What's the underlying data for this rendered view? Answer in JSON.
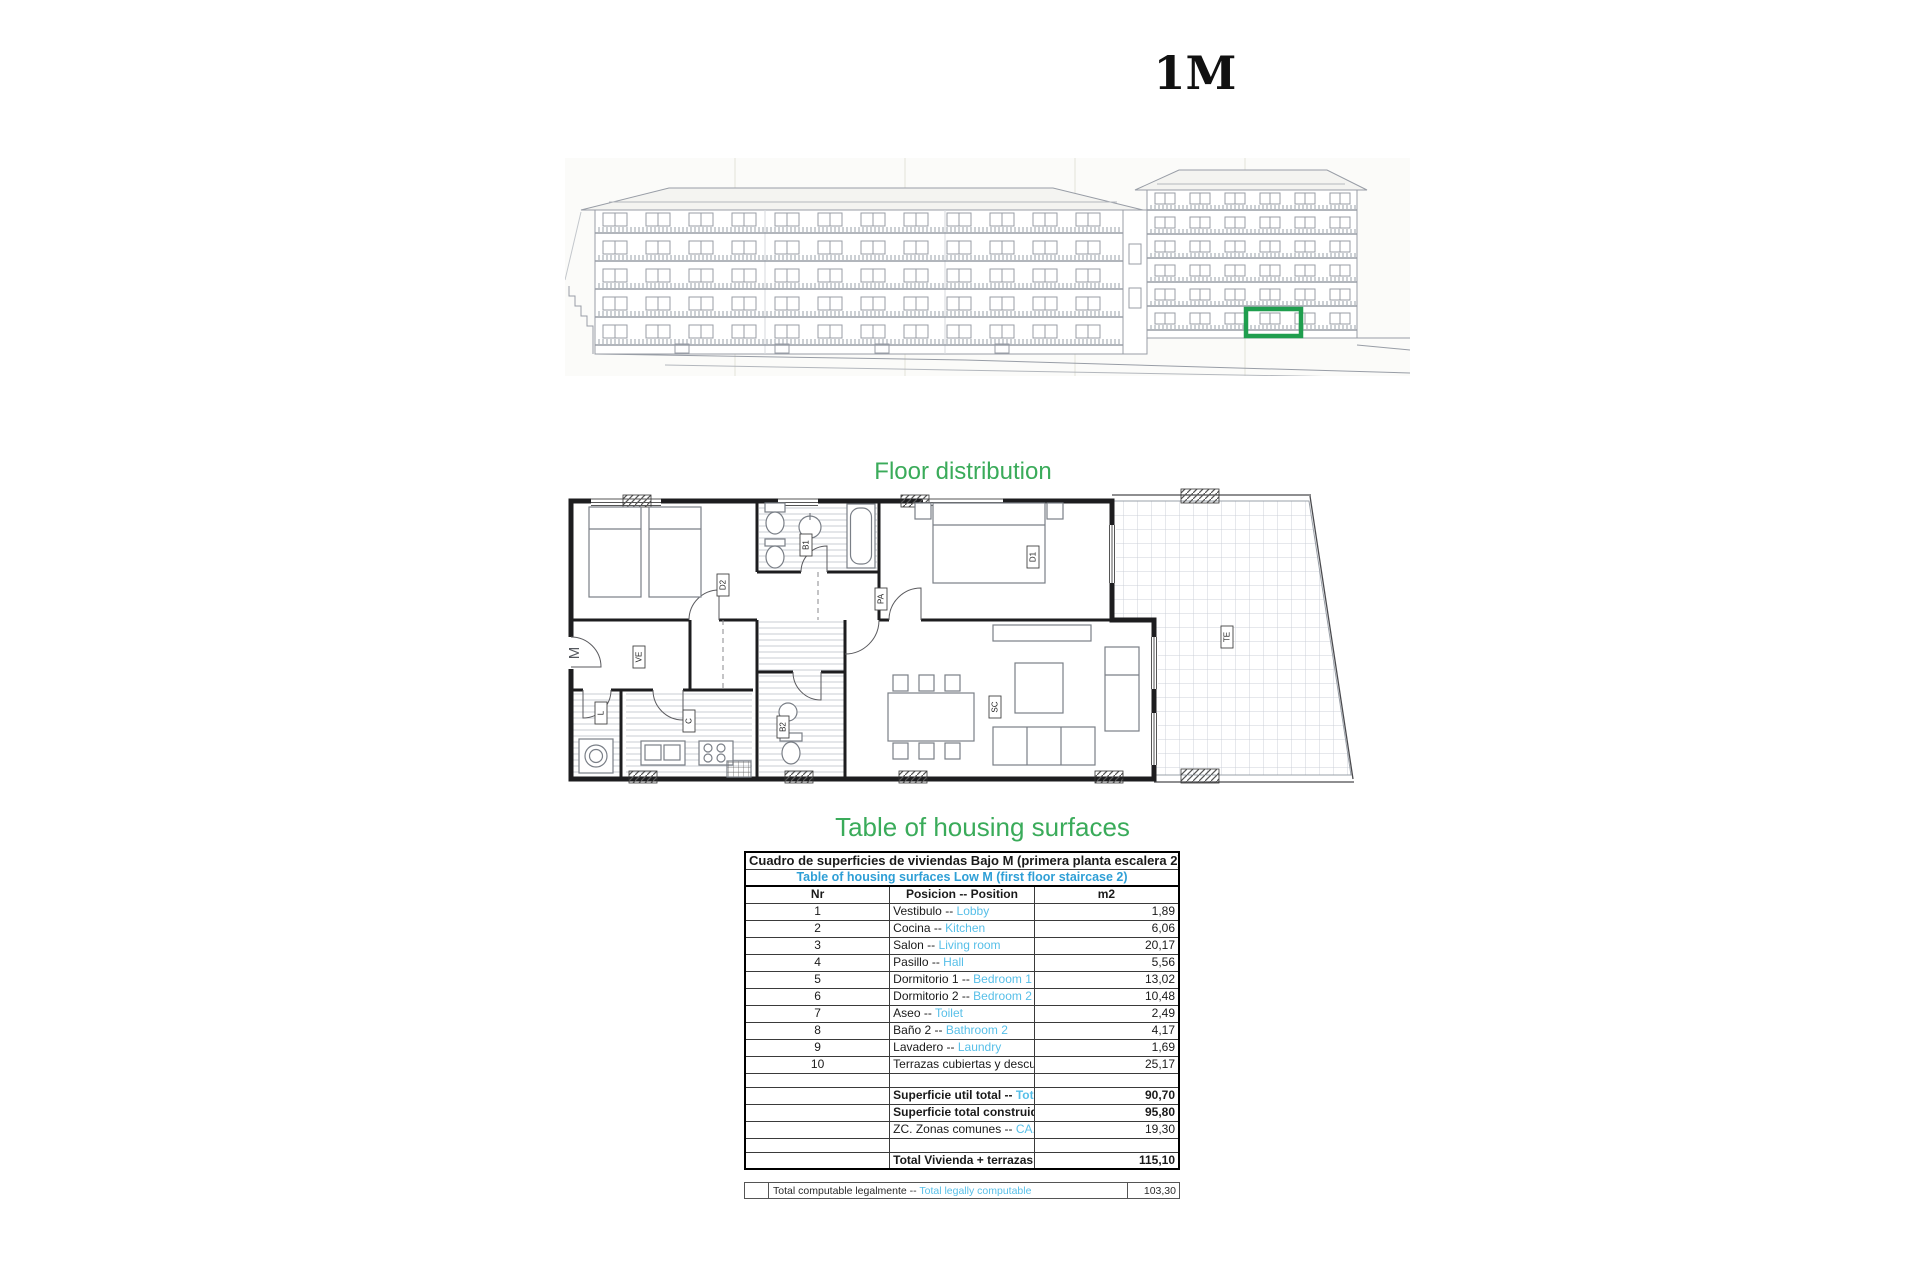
{
  "page_title": "1M",
  "colors": {
    "heading_green": "#3aab5a",
    "subtitle_blue": "#2e9fd6",
    "english_blue": "#57bfe8",
    "highlight_green": "#1f9e4e"
  },
  "headings": {
    "floor_distribution": "Floor distribution",
    "surfaces": "Table of housing surfaces"
  },
  "elevation": {
    "highlighted_unit": "ground-floor unit marked with green rectangle"
  },
  "floor_plan": {
    "labels": [
      {
        "text": "M",
        "x": 16,
        "y": 166,
        "plain": true
      },
      {
        "text": "D2",
        "x": 160,
        "y": 98
      },
      {
        "text": "B1",
        "x": 243,
        "y": 58
      },
      {
        "text": "D1",
        "x": 470,
        "y": 70
      },
      {
        "text": "PA",
        "x": 318,
        "y": 112
      },
      {
        "text": "VE",
        "x": 76,
        "y": 170
      },
      {
        "text": "L",
        "x": 38,
        "y": 226
      },
      {
        "text": "C",
        "x": 126,
        "y": 234
      },
      {
        "text": "B2",
        "x": 220,
        "y": 240
      },
      {
        "text": "SC",
        "x": 432,
        "y": 220
      },
      {
        "text": "TE",
        "x": 664,
        "y": 150
      }
    ]
  },
  "table": {
    "title_es": "Cuadro de superficies de viviendas Bajo M (primera planta escalera 2)",
    "title_en": "Table of housing surfaces Low M  (first floor staircase 2)",
    "headers": {
      "nr": "Nr",
      "position": "Posicion -- Position",
      "m2": "m2"
    },
    "rows": [
      {
        "nr": "1",
        "es": "Vestibulo -- ",
        "en": "Lobby",
        "m2": "1,89"
      },
      {
        "nr": "2",
        "es": "Cocina -- ",
        "en": " Kitchen",
        "m2": "6,06"
      },
      {
        "nr": "3",
        "es": "Salon -- ",
        "en": "Living room",
        "m2": "20,17"
      },
      {
        "nr": "4",
        "es": "Pasillo -- ",
        "en": "Hall",
        "m2": "5,56"
      },
      {
        "nr": "5",
        "es": "Dormitorio 1 -- ",
        "en": "Bedroom 1",
        "m2": "13,02"
      },
      {
        "nr": "6",
        "es": "Dormitorio 2 -- ",
        "en": "Bedroom 2",
        "m2": "10,48"
      },
      {
        "nr": "7",
        "es": "Aseo -- ",
        "en": "Toilet",
        "m2": "2,49"
      },
      {
        "nr": "8",
        "es": "Baño 2 -- ",
        "en": "Bathroom 2",
        "m2": "4,17"
      },
      {
        "nr": "9",
        "es": "Lavadero -- ",
        "en": "Laundry",
        "m2": "1,69"
      },
      {
        "nr": "10",
        "es": "Terrazas cubiertas y descubiertas -- ",
        "en": "Covered and uncovered terraces",
        "m2": "25,17"
      },
      {
        "empty": true
      },
      {
        "bold": true,
        "es": "Superficie util total -- ",
        "en": "Total usable area",
        "m2": "90,70"
      },
      {
        "bold": true,
        "es": "Superficie total construida -- ",
        "en": "Vivienda Total built area - Housing",
        "m2": "95,80"
      },
      {
        "es": "ZC. Zonas comunes  -- ",
        "en": "CA. Common areas",
        "m2": "19,30"
      },
      {
        "empty": true
      },
      {
        "bold": true,
        "es": "Total Vivienda + terrazas + ZC  -- ",
        "en": "Total Housing + terraces + CA",
        "m2": "115,10"
      }
    ],
    "footer_row": {
      "es": "Total computable legalmente -- ",
      "en": "Total legally computable",
      "m2": "103,30"
    }
  }
}
